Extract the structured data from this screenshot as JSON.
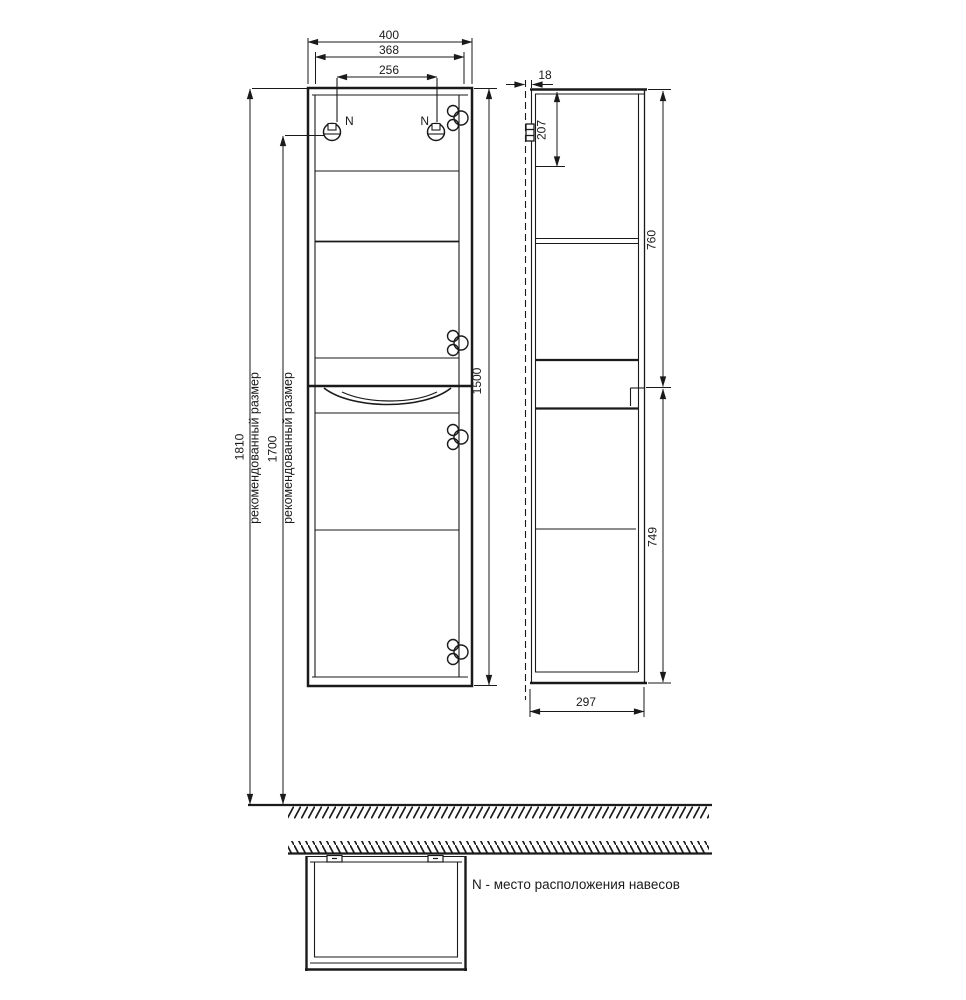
{
  "front": {
    "dim_width_outer": "400",
    "dim_width_inner": "368",
    "dim_hanger_spacing": "256",
    "dim_height": "1500",
    "hanger_left": "N",
    "hanger_right": "N"
  },
  "left_dims": {
    "overall": "1810",
    "overall_note": "рекомендованный размер",
    "hanger": "1700",
    "hanger_note": "рекомендованный размер"
  },
  "side": {
    "wall_gap": "18",
    "top_offset": "207",
    "upper_section": "760",
    "lower_section": "749",
    "depth": "297"
  },
  "footer": {
    "note": "N - место расположения навесов"
  },
  "colors": {
    "ink": "#1a1a1a",
    "background": "#ffffff"
  }
}
